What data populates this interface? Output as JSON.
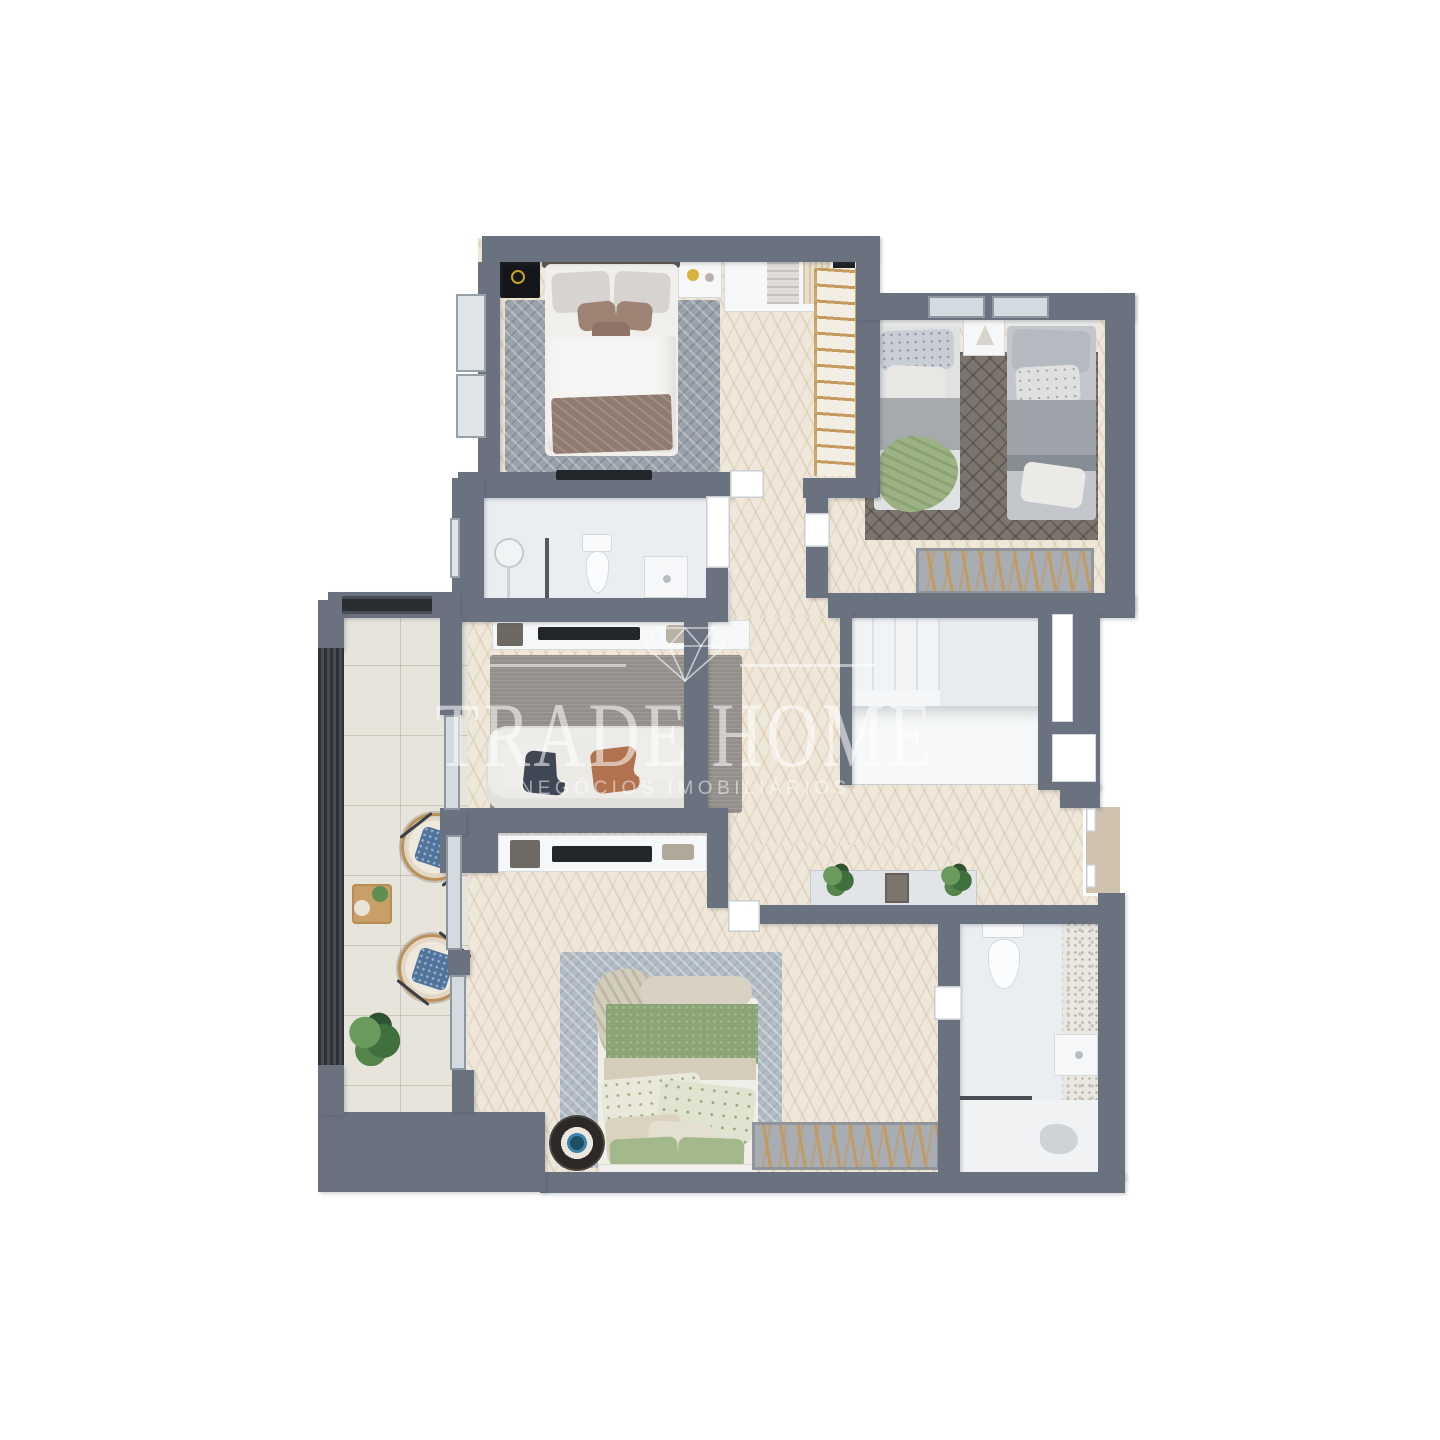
{
  "watermark": {
    "logo": "diamond-outline-icon",
    "title": "TRADE HOME",
    "subtitle": "NEGÓCIOS IMOBILIÁRIOS"
  },
  "palette": {
    "wall": "#6A7280",
    "wood_floor": "#EFE7D9",
    "bathroom_floor": "#EAEDF1",
    "balcony_tile": "#E7E4DB",
    "accent_wood": "#C49A5F",
    "green_bedding": "#8CA577",
    "blue_cushion": "#50749C",
    "watermark_white": "rgba(255,255,255,0.55)"
  },
  "scene": {
    "type": "3d-floor-plan-top-view-render",
    "background": "#FFFFFF"
  }
}
